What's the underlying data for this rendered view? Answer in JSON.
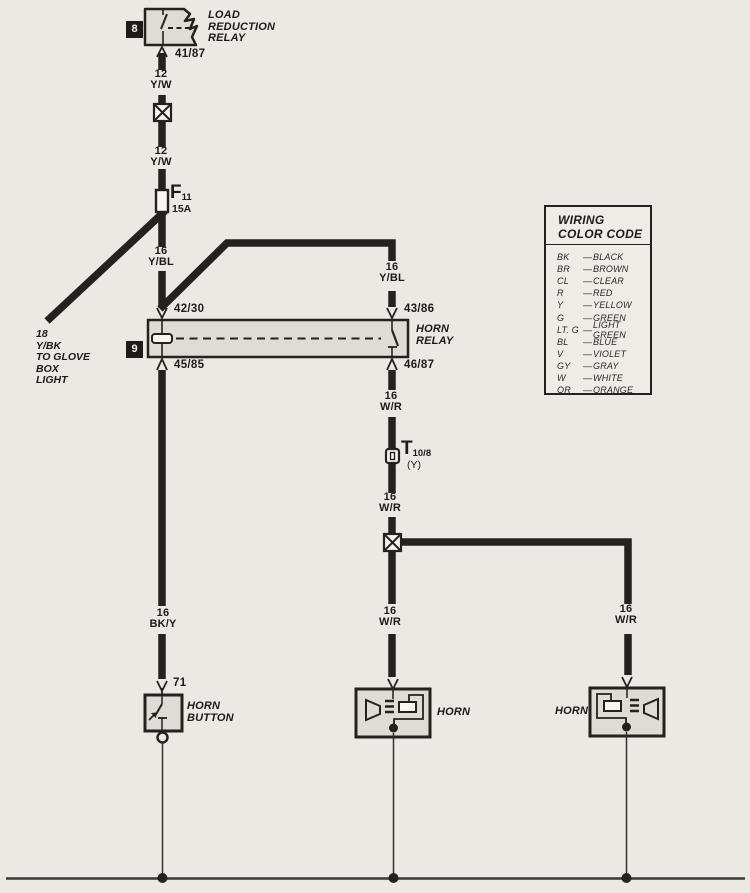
{
  "colors": {
    "background": "#eae9e4",
    "ink": "#23221e",
    "box_fill": "#dddcd5",
    "symbol_fill": "#f7f6f1"
  },
  "load_reduction_relay": {
    "tag": "8",
    "name": "LOAD\nREDUCTION\nRELAY",
    "terminal": "41/87"
  },
  "fuse": {
    "id": "F",
    "sub": "11",
    "rating": "15A"
  },
  "glove_box": {
    "label": "18\nY/BK\nTO GLOVE\nBOX\nLIGHT"
  },
  "horn_relay": {
    "tag": "9",
    "name": "HORN\nRELAY",
    "t_top_left": "42/30",
    "t_top_right": "43/86",
    "t_bottom_left": "45/85",
    "t_bottom_right": "46/87"
  },
  "t_connector": {
    "id": "T",
    "sub": "10/8",
    "note": "(Y)"
  },
  "horn_button": {
    "name": "HORN\nBUTTON",
    "terminal": "71"
  },
  "horns": {
    "left": "HORN",
    "right": "HORN"
  },
  "wire_labels": {
    "yw_upper": "12\nY/W",
    "yw_lower": "12\nY/W",
    "ybl_left": "16\nY/BL",
    "ybl_right": "16\nY/BL",
    "wr_relay": "16\nW/R",
    "wr_mid": "16\nW/R",
    "wr_left_horn": "16\nW/R",
    "wr_right_horn": "16\nW/R",
    "bky": "16\nBK/Y"
  },
  "legend": {
    "title": "WIRING\nCOLOR CODE",
    "separator": "—",
    "entries": [
      {
        "abbr": "BK",
        "name": "BLACK"
      },
      {
        "abbr": "BR",
        "name": "BROWN"
      },
      {
        "abbr": "CL",
        "name": "CLEAR"
      },
      {
        "abbr": "R",
        "name": "RED"
      },
      {
        "abbr": "Y",
        "name": "YELLOW"
      },
      {
        "abbr": "G",
        "name": "GREEN"
      },
      {
        "abbr": "LT. G",
        "name": "LIGHT GREEN"
      },
      {
        "abbr": "BL",
        "name": "BLUE"
      },
      {
        "abbr": "V",
        "name": "VIOLET"
      },
      {
        "abbr": "GY",
        "name": "GRAY"
      },
      {
        "abbr": "W",
        "name": "WHITE"
      },
      {
        "abbr": "OR",
        "name": "ORANGE"
      }
    ]
  }
}
